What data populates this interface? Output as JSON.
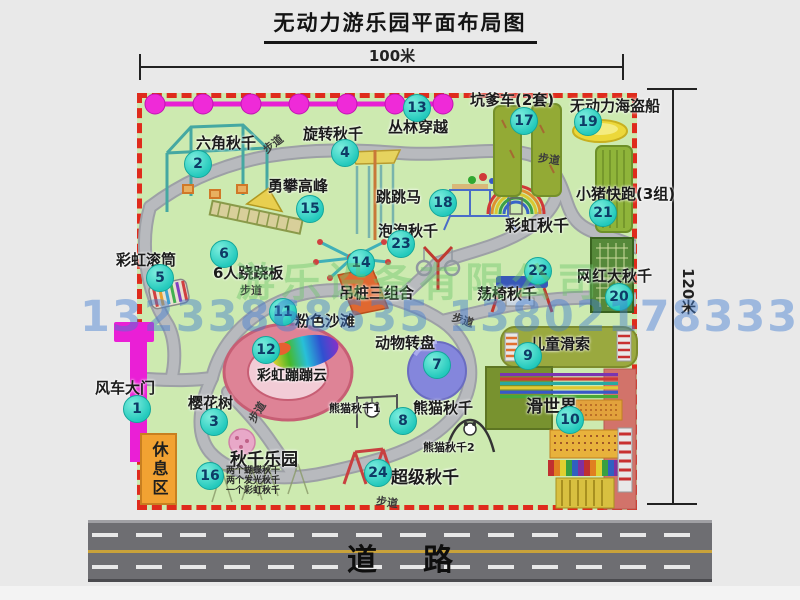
{
  "title": "无动力游乐园平面布局图",
  "dimension_top": "100米",
  "dimension_right": "120米",
  "walkway_label": "步道",
  "road_label": "道路",
  "rest_area_label": "休息区",
  "watermark": {
    "phone": "13233868635 13802178333",
    "company": "游乐设备有限公司"
  },
  "extra_labels": {
    "rainbow_swing": "彩虹秋千",
    "panda_swing_1": "熊猫秋千1",
    "panda_swing_2": "熊猫秋千2"
  },
  "legend_items": [
    {
      "num": "1",
      "label": "风车大门"
    },
    {
      "num": "2",
      "label": "六角秋千"
    },
    {
      "num": "3",
      "label": "樱花树"
    },
    {
      "num": "4",
      "label": "旋转秋千"
    },
    {
      "num": "5",
      "label": "彩虹滚筒"
    },
    {
      "num": "6",
      "label": "6人跷跷板"
    },
    {
      "num": "7",
      "label": "动物转盘"
    },
    {
      "num": "8",
      "label": "熊猫秋千"
    },
    {
      "num": "9",
      "label": "儿童滑索"
    },
    {
      "num": "10",
      "label": "滑世界"
    },
    {
      "num": "11",
      "label": "粉色沙滩"
    },
    {
      "num": "12",
      "label": "彩虹蹦蹦云"
    },
    {
      "num": "13",
      "label": "丛林穿越"
    },
    {
      "num": "14",
      "label": "吊桩三组合"
    },
    {
      "num": "15",
      "label": "勇攀高峰"
    },
    {
      "num": "16",
      "label": "秋千乐园",
      "notes": [
        "两个蝴蝶秋千",
        "两个发光秋千",
        "一个彩虹秋千"
      ]
    },
    {
      "num": "17",
      "label": "坑爹车(2套)"
    },
    {
      "num": "18",
      "label": "跳跳马"
    },
    {
      "num": "19",
      "label": "无动力海盗船"
    },
    {
      "num": "20",
      "label": "网红大秋千"
    },
    {
      "num": "21",
      "label": "小猪快跑(3组)"
    },
    {
      "num": "22",
      "label": "荡椅秋千"
    },
    {
      "num": "23",
      "label": "泡泡秋千"
    },
    {
      "num": "24",
      "label": "超级秋千"
    }
  ],
  "colors": {
    "map_green": "#cdeab0",
    "border_red": "#df2b1c",
    "badge_teal": "#23c9bc",
    "gate_magenta": "#ea1fd6",
    "road_gray": "#6e6e72",
    "path_gray": "#b4b6ba",
    "rest_orange": "#f2a232"
  }
}
